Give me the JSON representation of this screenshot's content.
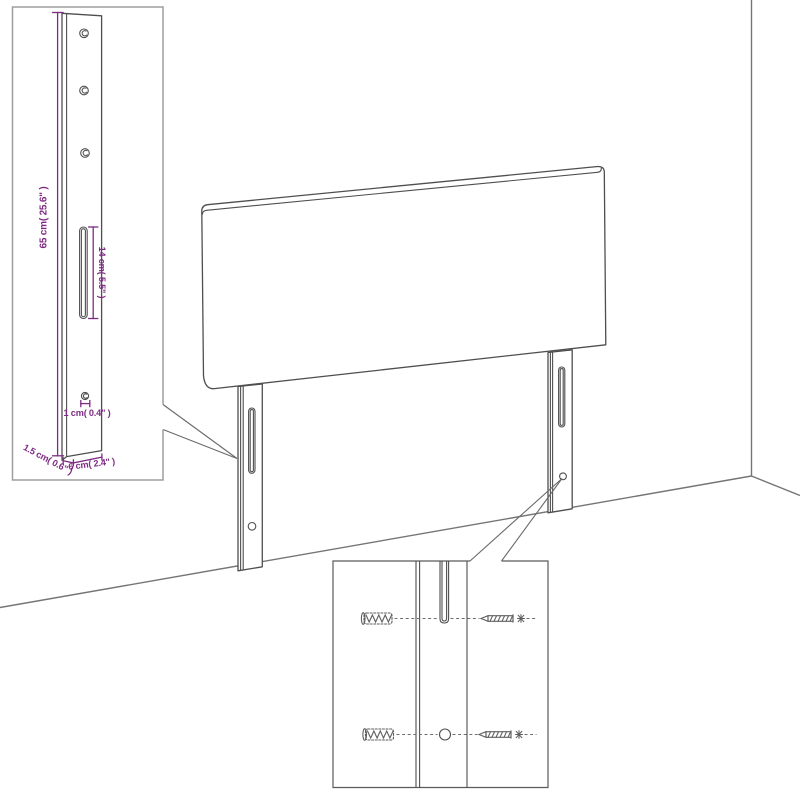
{
  "diagram": {
    "type": "product-dimension-diagram",
    "subject": "upholstered headboard with two slotted legs shown against a room corner",
    "background": "#ffffff",
    "colors": {
      "product_line": "#4f4f4f",
      "room_line": "#757575",
      "inset_border": "#9e9e9e",
      "dimension": "#7e2b84"
    },
    "leg_inset": {
      "description": "enlarged detail of one leg with dimensions",
      "labels": {
        "height": "65 cm( 25.6\" )",
        "slot_length": "14 cm( 5.5\" )",
        "hole_diameter": "1 cm( 0.4\" )",
        "leg_depth": "1.5 cm( 0.6\" )",
        "leg_width": "6 cm( 2.4\" )"
      }
    },
    "mounting_inset": {
      "description": "enlarged detail of leg slot and hole with wall plugs and screws",
      "icons": [
        "wall-plug-icon",
        "screw-icon"
      ]
    }
  }
}
